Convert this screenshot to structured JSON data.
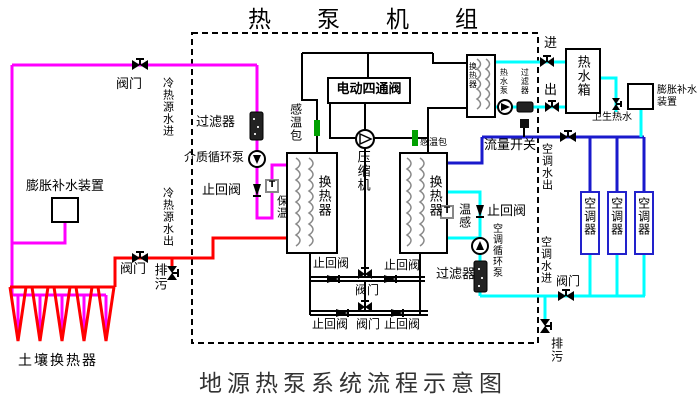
{
  "title": "热泵机组",
  "caption": "地源热泵系统流程示意图",
  "colors": {
    "source_supply": "#ff00ff",
    "source_return": "#ff0000",
    "ac_supply": "#1a1acc",
    "ac_return": "#00ffff",
    "refrigerant": "#000000",
    "sensor_tick": "#00a000",
    "ac_unit_border": "#2222cc"
  },
  "labels": {
    "valve_src_in": "阀门",
    "src_in": "冷热源水进",
    "src_out": "冷热源水出",
    "expansion_left_title": "膨胀补水装置",
    "filter_left": "过滤器",
    "medium_pump": "介质循环泵",
    "check_left": "止回阀",
    "insulation": "保温",
    "bulb_left": "感温包",
    "fourway": "电动四通阀",
    "compressor": "压缩机",
    "hx_left": "换热器",
    "hx_right": "换热器",
    "bulb_right": "感温包",
    "flow_switch": "流量开关",
    "temp_sense": "温感",
    "check_ac": "止回阀",
    "ac_pump": "空调循环泵",
    "filter_ac": "过滤器",
    "hx_hw": "换热器",
    "hw_pump": "热水泵",
    "hw_filter": "过滤器",
    "in": "进",
    "out": "出",
    "tank": "热水箱",
    "sanitary": "卫生热水",
    "expansion_right_title": "膨胀补水装置",
    "ac_water_out": "空调水出",
    "ac_water_in": "空调水进",
    "ac1": "空调器",
    "ac2": "空调器",
    "ac3": "空调器",
    "valve_ac": "阀门",
    "drain_right": "排污",
    "check_row1_left": "止回阀",
    "check_row1_right": "止回阀",
    "valve_row1": "阀门",
    "check_row2_left": "止回阀",
    "valve_row2": "阀门",
    "check_row2_right": "止回阀",
    "valve_ground": "阀门",
    "drain_left": "排污",
    "soil_hx": "土壤换热器",
    "t_sensor": "T"
  }
}
